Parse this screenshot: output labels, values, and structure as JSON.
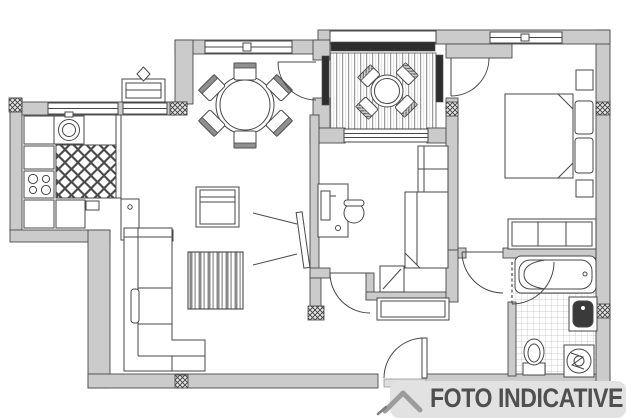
{
  "badge": {
    "label": "FOTO INDICATIVE",
    "logo_icon": "mountain-chevron-icon"
  },
  "colors": {
    "line": "#474747",
    "wall_fill": "#cbcbcb",
    "glazing_dark": "#2e2e2e",
    "badge_bg": "#e2e2e2",
    "badge_text": "#4f4f4f",
    "logo_gray": "#9c9c9c"
  },
  "plan": {
    "type": "apartment-floor-plan",
    "rooms": [
      "kitchen",
      "dining-area",
      "terrace",
      "living-room",
      "study-bedroom",
      "bedroom",
      "hallway",
      "bathroom"
    ],
    "furniture_icons": [
      "kitchen-sink-icon",
      "stove-icon",
      "fridge-icon",
      "checker-floor",
      "radiator-icon",
      "dining-table-6-chairs-icon",
      "terrace-table-4-chairs-icon",
      "coffee-table-icon",
      "corner-sofa-icon",
      "tv-icon",
      "tv-cabinet-icon",
      "desk-icon",
      "office-chair-icon",
      "single-bed-icon",
      "wardrobe-icon",
      "double-bed-icon",
      "nightstand-icon",
      "hallway-cabinet-icon",
      "bathtub-icon",
      "washbasin-icon",
      "toilet-icon",
      "washing-machine-icon",
      "door-arc",
      "entrance-door",
      "column-hatch",
      "window"
    ]
  }
}
